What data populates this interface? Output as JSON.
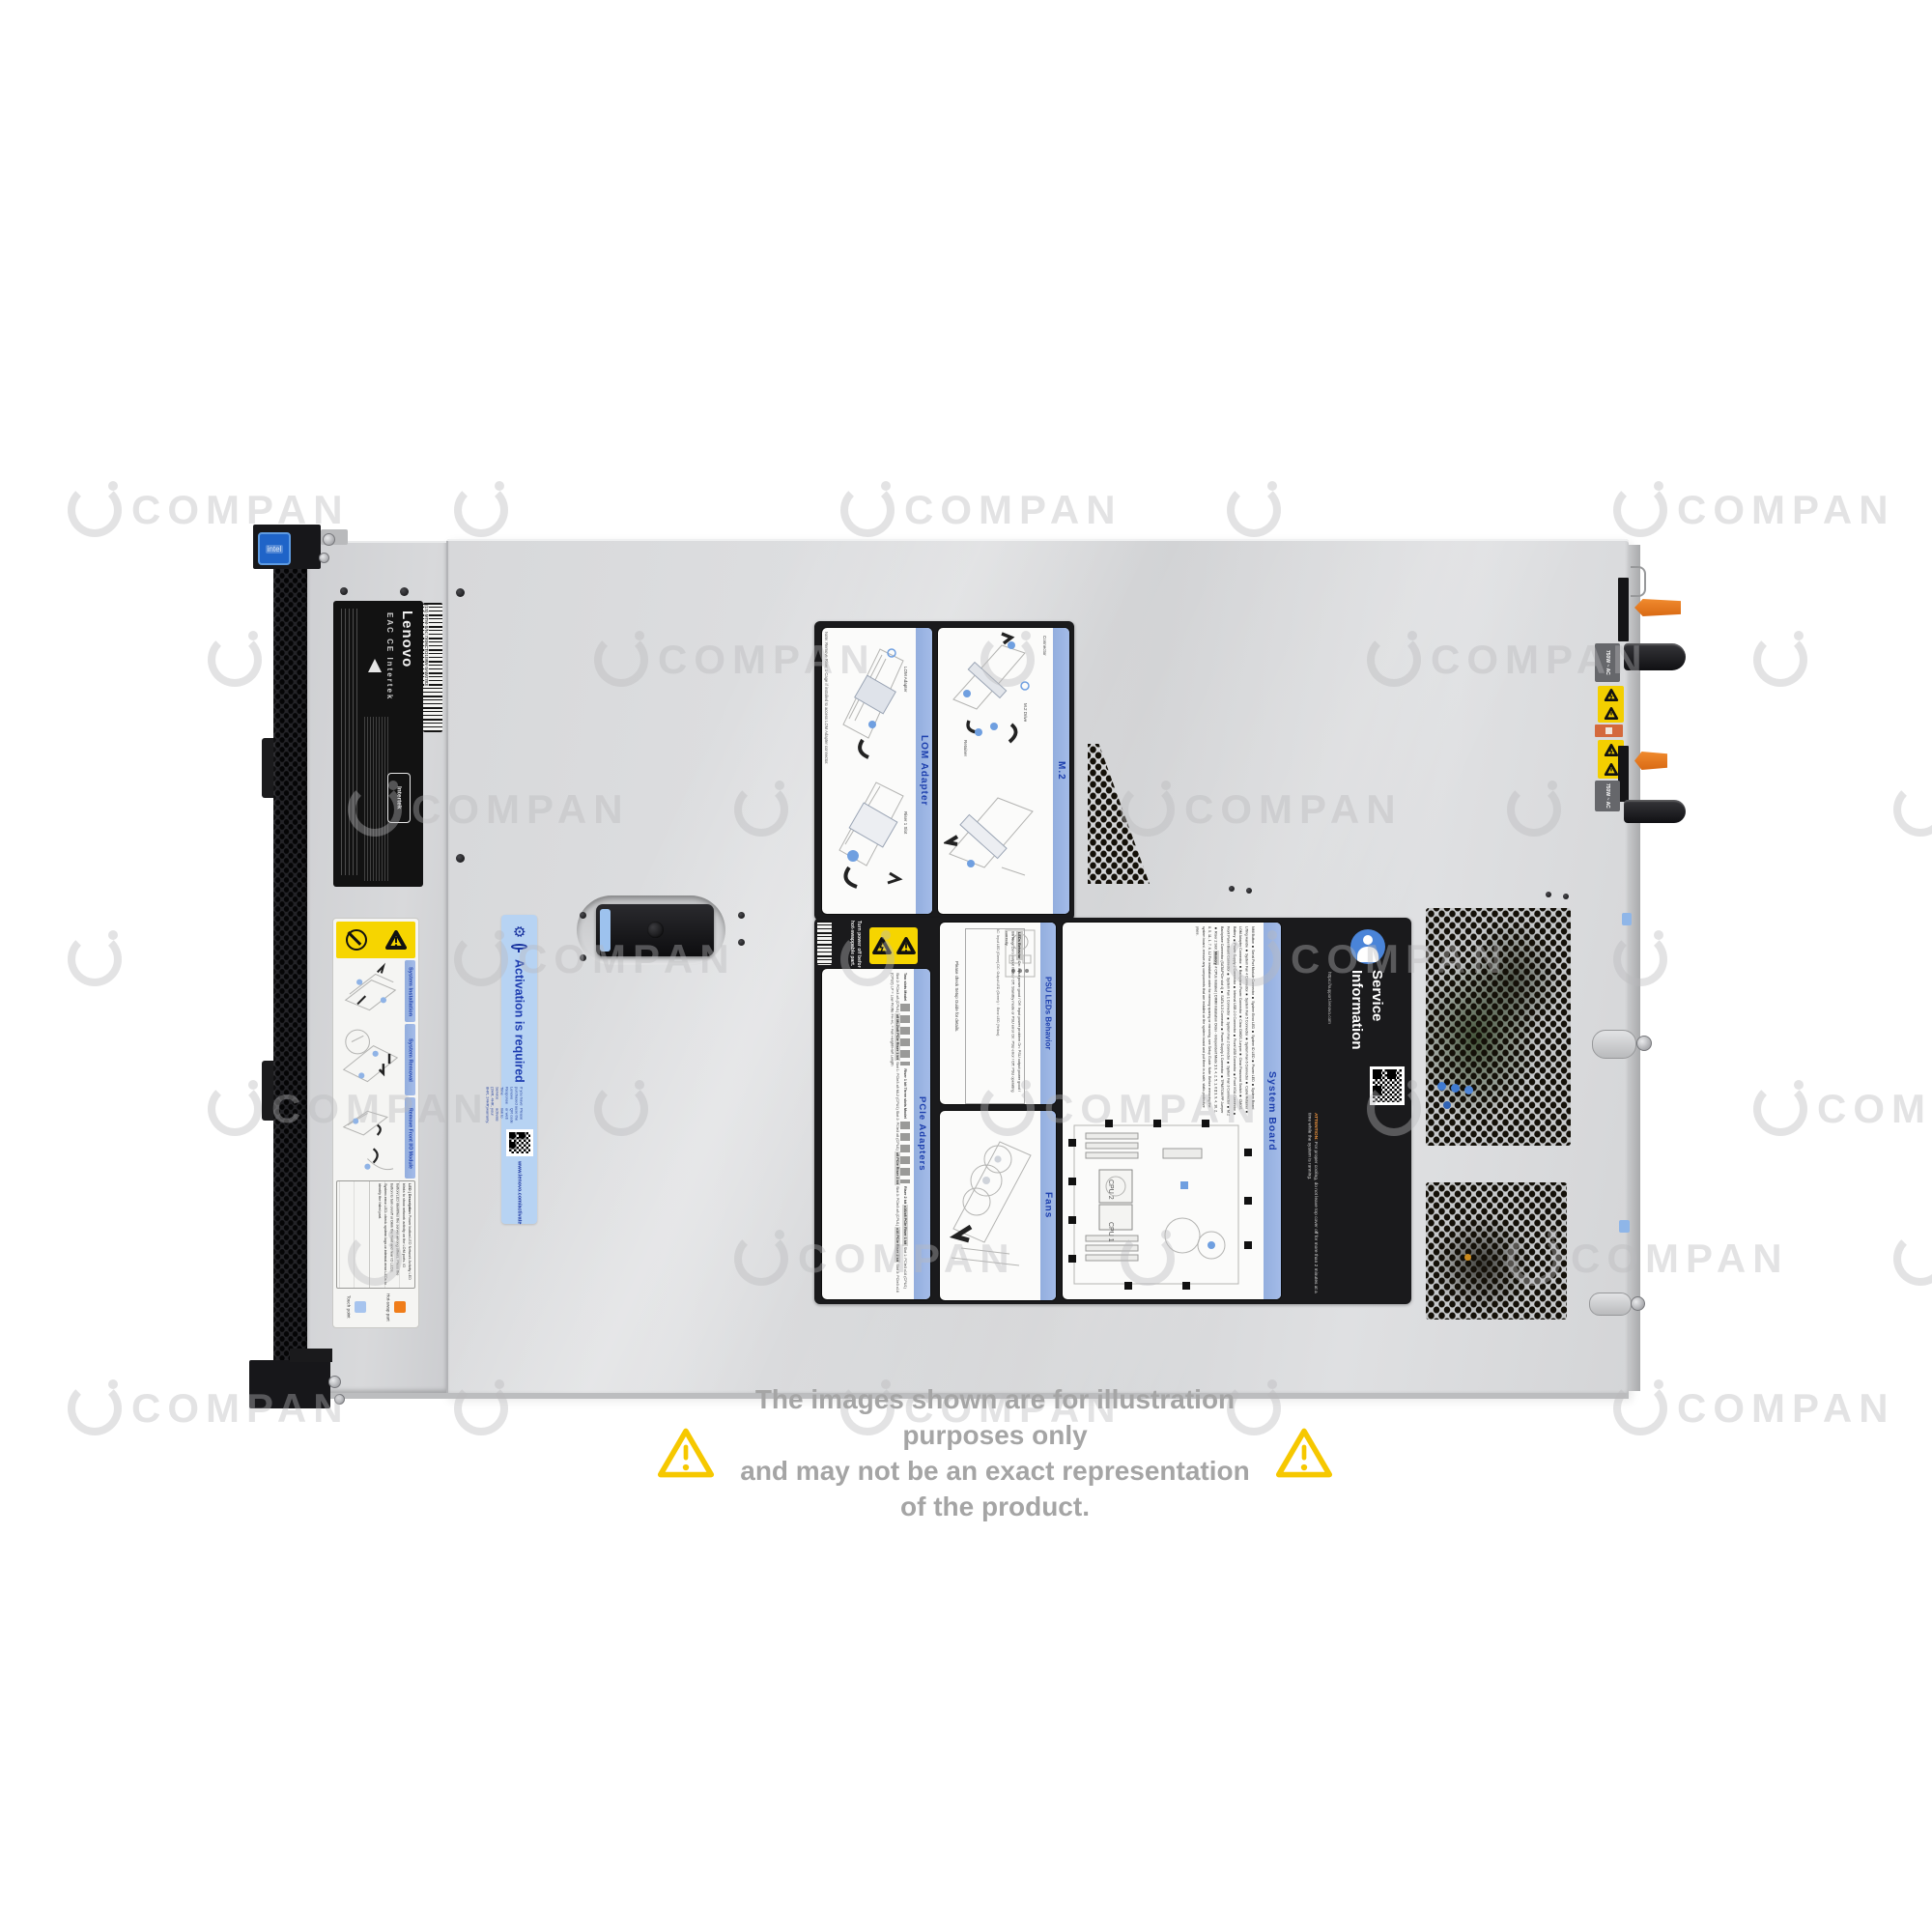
{
  "scene": {
    "description": "Top view product photo of a Lenovo 1U rack server with service labels",
    "background_color": "#ffffff"
  },
  "watermark": {
    "text": "COMPAN"
  },
  "disclaimer": {
    "line1": "The images shown are for illustration purposes only",
    "line2": "and may not be an exact representation of the product."
  },
  "chassis": {
    "brand": "Lenovo",
    "intel_badge": "intel",
    "serial_barcode": "(1S) MTM-S/N: 7X06CTO1WW-SAWJ783",
    "certifications": [
      "EAC",
      "CE",
      "Intertek"
    ],
    "psu_label_1": "750W ~ AC",
    "psu_label_2": "750W ~ AC"
  },
  "front_service_label": {
    "sections": [
      {
        "title": "System Installation"
      },
      {
        "title": "System Removal"
      },
      {
        "title": "Remove Front I/O Module"
      }
    ],
    "led_table": {
      "headers": [
        "LED",
        "Description"
      ],
      "rows": [
        {
          "desc": "Power button/LED"
        },
        {
          "desc": "Network Activity LED blinks to show network activity on the LOM ports."
        },
        {
          "desc": "ID button/LED identifies the server among others. Press the button to turn on/off or blink the front and rear ID LEDs."
        },
        {
          "desc": "System error LED: check system logs or internal error LEDs to identify the failed part."
        }
      ]
    },
    "legend": [
      {
        "label": "Touch point",
        "color": "#a7c4ee"
      },
      {
        "label": "Hot-swap part",
        "color": "#f07d1a"
      }
    ]
  },
  "activation_sticker": {
    "title": "Activation is required",
    "note": "If you have purchased a Lenovo Response Time Service (2HR, 4HR, 8HR, 24HR)",
    "instruction": "Please use the QR code or web link to activate your warranty.",
    "url": "www.lenovo.com/activate"
  },
  "service_panel": {
    "lom_adapter": {
      "title": "LOM Adapter",
      "note": "Note: Remove Riser 1 Cage if installed to access LOM Adapter connector.",
      "captions": [
        "LOM Adapter",
        "Riser 1 Slot"
      ]
    },
    "m2": {
      "title": "M.2",
      "captions": [
        "Connector",
        "M.2 Drive",
        "Retainer"
      ]
    },
    "power_warning": "Turn power off before removing any non-hot-swappable part.",
    "psu_leds": {
      "title": "PSU LEDs Behavior",
      "table_title": "LEDs Behavior",
      "rows": [
        {
          "led": "AC",
          "behavior": "On: Input power good / Off: Input power problem"
        },
        {
          "led": "DC",
          "behavior": "On: PSU output power good / Blinking: Zero output mode / Off: Standby mode or PSU error"
        },
        {
          "led": "!",
          "behavior": "On: PSU error / Off: PSU operating correctly"
        }
      ],
      "legend": "AC: Input LED (Green)  DC: Output LED (Green)  ! : Error LED (Yellow)",
      "note": "Please check Setup Guide for details."
    },
    "pcie_adapters": {
      "title": "PCIe Adapters",
      "models": [
        "Two slots Model",
        "Three slots Model",
        "Riser 1 kit",
        "Riser 2 kit"
      ],
      "kits": [
        {
          "name": "x16/x8 PCIe Riser 1 kit",
          "slots": "Slot 1: PCIe3 x16 (CPU1)  Slot 2: PCIe3 x8 (CPU1)"
        },
        {
          "name": "x8 ML2/x8 PCIe Riser 1 kit",
          "slots": "Slot 1: PCIe3 x8 ML2 (CPU1)  Slot 2: PCIe3 x8 (CPU1)"
        },
        {
          "name": "x8 PCIe Riser 2 kit",
          "slots": "Slot 3: PCIe3 x8 (CPU1)"
        },
        {
          "name": "x16 PCIe Riser 2 kit",
          "slots": "Slot 3: PCIe3 x16 (CPU2)"
        }
      ],
      "abbreviations": "LP = Low Profile   FH-HL = Full Height/Half Length"
    },
    "fans": {
      "title": "Fans"
    },
    "system_board": {
      "title": "System Board",
      "connectors": [
        "NMI Button",
        "Serial Port Module Connector",
        "System Error LED",
        "System ID LED",
        "Power LED",
        "System Board Lifting Handle",
        "System Fan 4 Connector",
        "System Fan 5 Connector",
        "System Fan 6 Connector",
        "Cable Retainer",
        "LOM Adapter Connector",
        "Backplane Power Connector",
        "Clear CMOS Jumper",
        "Clear Password Switch",
        "CMOS Battery",
        "Power Supply 2 Connector",
        "Internal USB 2.0 Connector",
        "Front USB Connector",
        "Front VGA Connector",
        "Front Panel Board Connector",
        "System Fan 1 Connector",
        "System Fan 2 Connector",
        "System Fan 3 Connector",
        "M.2 Backplane Connector (SATA/PCIe slot 4)",
        "SATA 0-3 Connector",
        "Power Supply 1 Connector",
        "TPM/TCM PP Jumper",
        "Riser 2 Slot"
      ],
      "memory": {
        "title": "Memory",
        "headers": [
          "# CPUs Installed",
          "DIMM Installation Order - Independent Mode"
        ],
        "rows": [
          {
            "cpus": "1",
            "order": "3, 4, 2, 5, 1, 6"
          },
          {
            "cpus": "2",
            "order": "3, 9, 4, 10, 2, 8, 5, 11, 1, 7, 6, 12"
          }
        ],
        "footnote": "For installation order for memory sparing or mirroring, see Setup Guide."
      },
      "note": "Note: Before removing the system board, remove any components that are installed on the system board and put them in a safe, static-protective place.",
      "cpu_labels": [
        "CPU 1",
        "CPU 2"
      ]
    },
    "service_information": {
      "title": "Service Information",
      "url": "https://support.lenovo.com",
      "attention_title": "ATTENTION:",
      "attention_text": "For proper cooling, do not leave top cover off for more than 2 minutes at a time while the system is running."
    }
  }
}
